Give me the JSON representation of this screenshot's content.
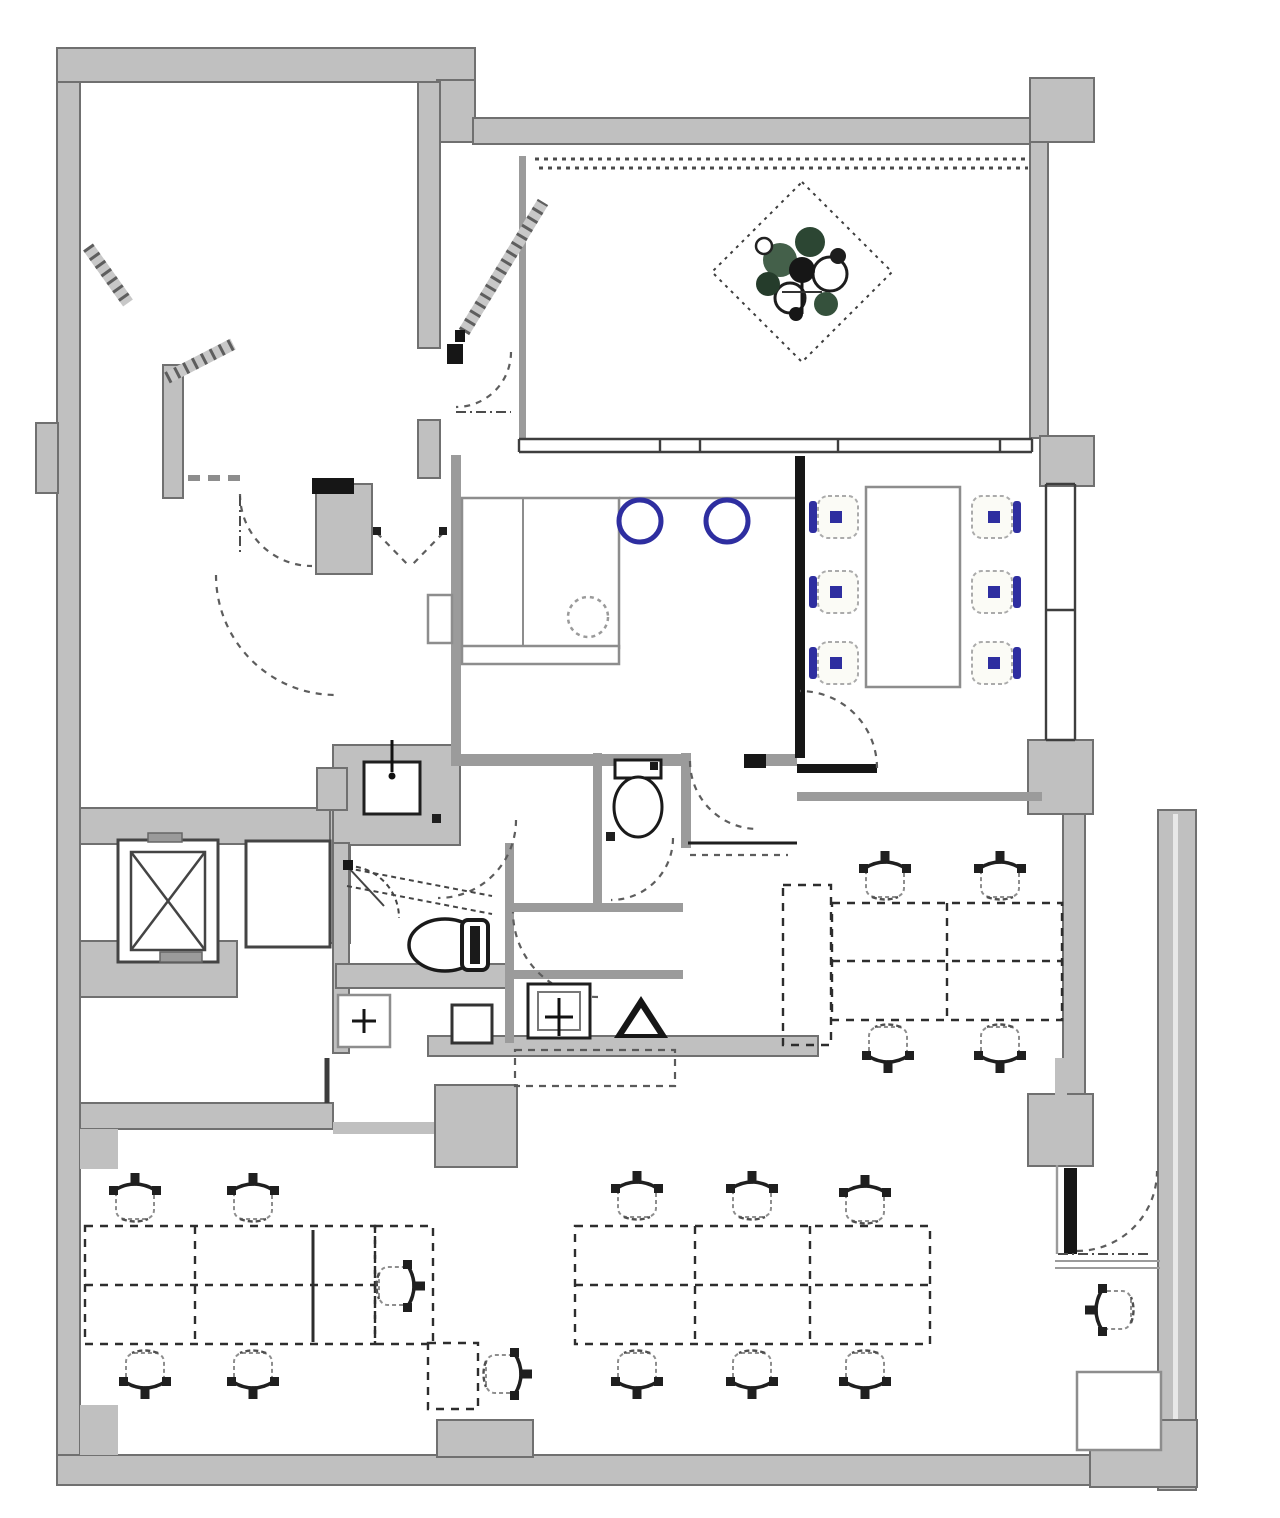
{
  "meta": {
    "title": "Office floor plan drawing",
    "width": 1280,
    "height": 1518
  },
  "colors": {
    "bg": "#ffffff",
    "wall": "#c0c0c0",
    "wallEdge": "#707070",
    "wallLight": "#9b9b9b",
    "line": "#1f1f1f",
    "lineMid": "#555555",
    "lineLight": "#8d8d8d",
    "accent": "#2e2ea0",
    "black": "#161616",
    "plantGreen": "#44604a",
    "plantGreenDark": "#2c4633"
  },
  "rooms": [
    {
      "name": "upper-left-room"
    },
    {
      "name": "upper-right-terrace-room"
    },
    {
      "name": "kitchen"
    },
    {
      "name": "meeting-room"
    },
    {
      "name": "elevator-lobby"
    },
    {
      "name": "restrooms"
    },
    {
      "name": "open-office-right"
    },
    {
      "name": "open-office-bottom"
    }
  ],
  "fixtures": [
    {
      "name": "planter-diamond",
      "count": 1
    },
    {
      "name": "stove-burner",
      "count": 2
    },
    {
      "name": "kitchen-sink",
      "count": 1
    },
    {
      "name": "meeting-table",
      "count": 1
    },
    {
      "name": "meeting-chair",
      "count": 6
    },
    {
      "name": "office-chair",
      "count": 17
    },
    {
      "name": "desk-cluster",
      "count": 4
    },
    {
      "name": "elevator-shaft",
      "count": 2
    },
    {
      "name": "toilet",
      "count": 2
    },
    {
      "name": "wash-basin",
      "count": 4
    },
    {
      "name": "door-swing",
      "count": 10
    },
    {
      "name": "window-band",
      "count": 3
    }
  ]
}
